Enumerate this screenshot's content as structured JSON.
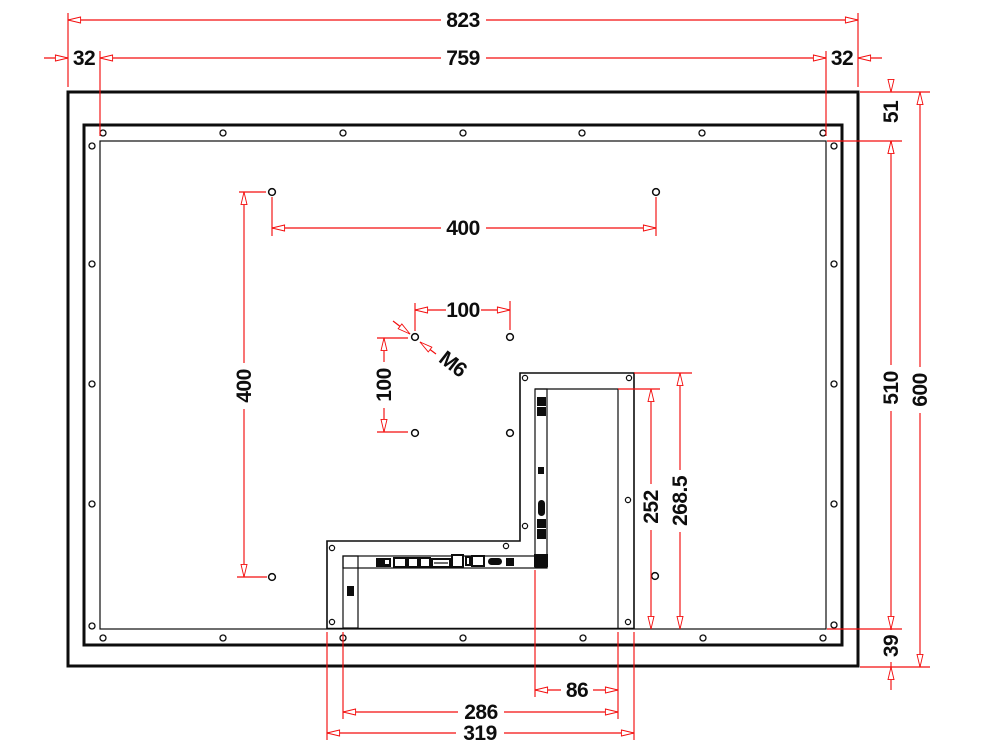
{
  "drawing": {
    "type": "technical-dimension-drawing",
    "subject": "display-rear-panel-with-vesa-mount-and-connector-bracket",
    "colors": {
      "background": "#ffffff",
      "object_lines": "#0d0d0d",
      "dimension_lines": "#f30d0d",
      "dimension_text": "#0d0d0d"
    },
    "dims": {
      "overall_width": "823",
      "visible_width": "759",
      "left_margin": "32",
      "right_margin": "32",
      "top_margin": "51",
      "visible_height": "510",
      "overall_height": "600",
      "bottom_margin": "39",
      "vesa_horizontal": "400",
      "vesa_vertical": "400",
      "vesa100_horizontal": "100",
      "vesa100_vertical": "100",
      "thread": "M6",
      "bracket_opening_height": "252",
      "bracket_height": "268.5",
      "connector_offset": "86",
      "bracket_opening_width": "286",
      "bracket_width": "319"
    }
  }
}
